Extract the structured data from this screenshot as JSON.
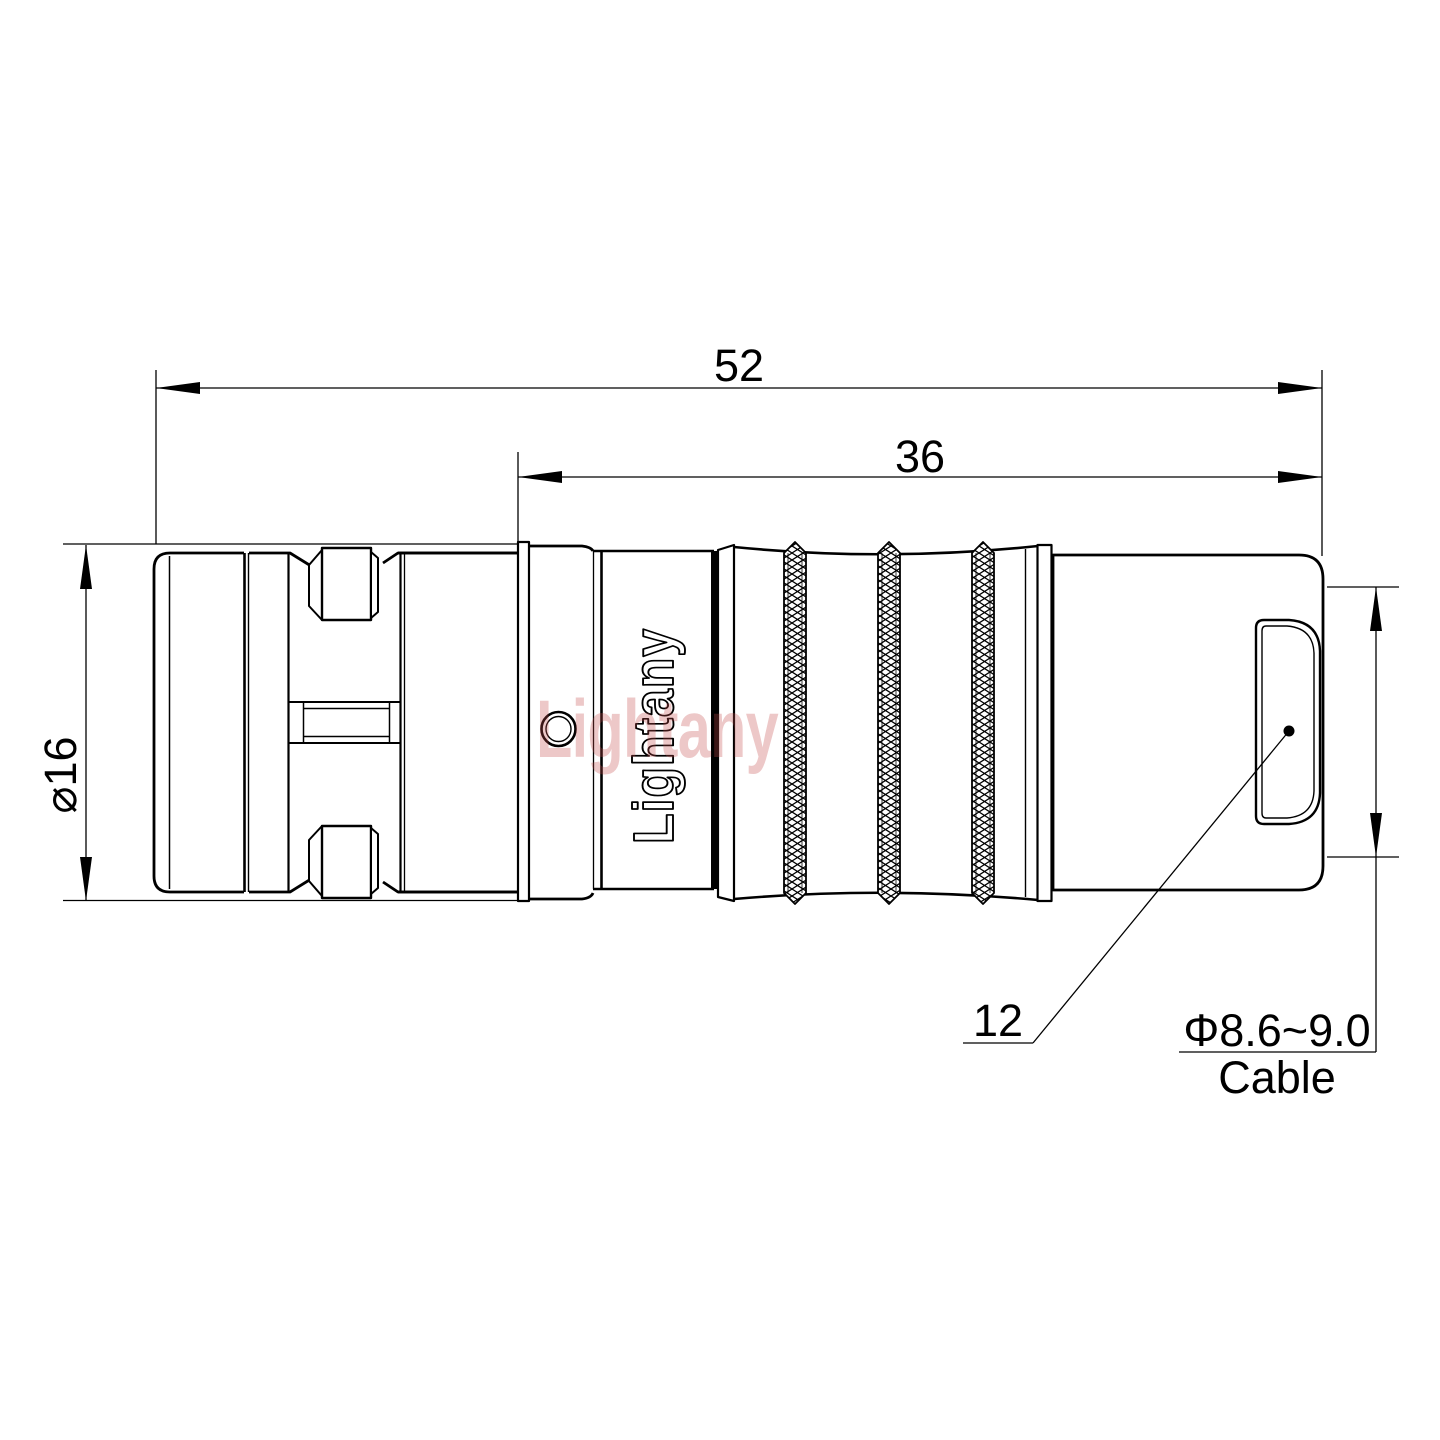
{
  "page": {
    "background": "#ffffff"
  },
  "colors": {
    "line": "#000000",
    "watermark_pink": "#c24a4a"
  },
  "drawing": {
    "dim_overall_length": "52",
    "dim_rear_section_length": "36",
    "dim_front_diameter": "⌀16",
    "dim_rear_diameter": "12",
    "cable_diameter_spec": "Φ8.6~9.0",
    "cable_label": "Cable",
    "body_engraving": "Lightany",
    "watermark_text": "Lightany"
  }
}
